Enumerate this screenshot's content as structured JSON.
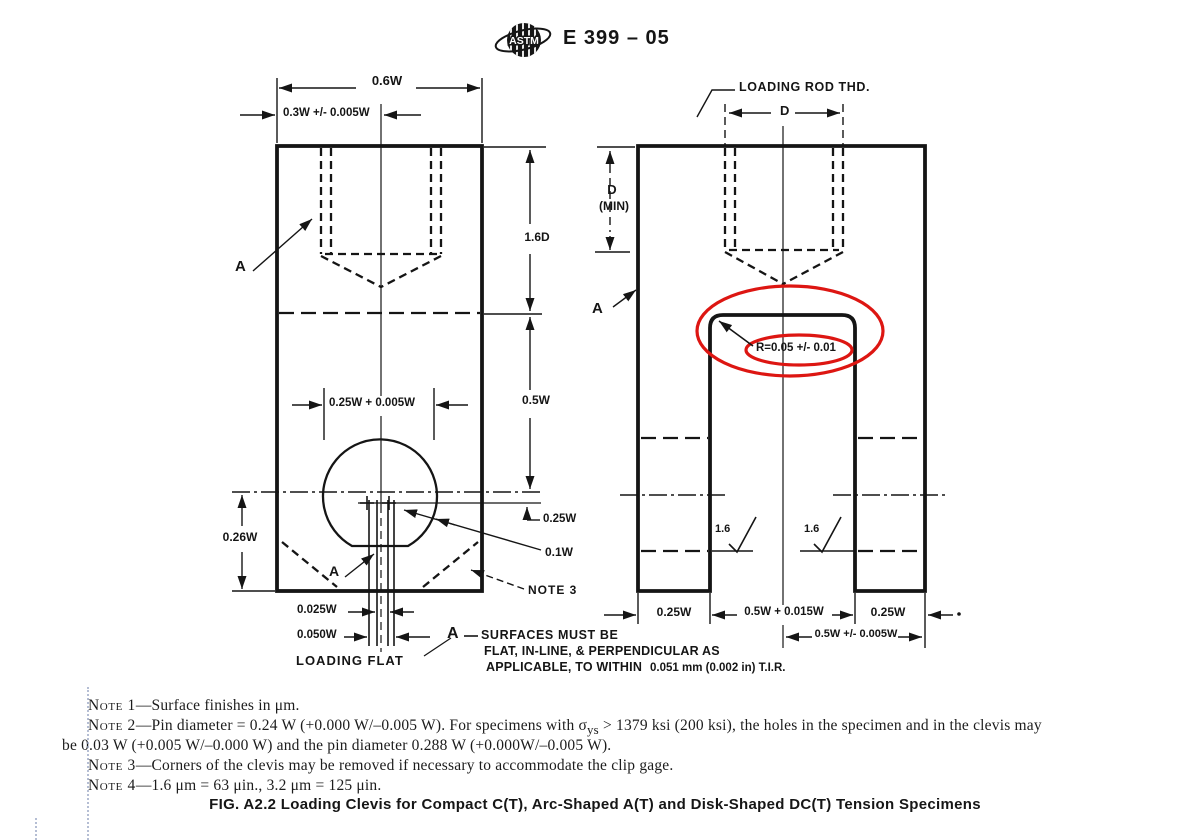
{
  "colors": {
    "ink": "#151515",
    "highlight_red": "#dd1612",
    "scan_artifact_blue": "#97a3c2"
  },
  "header": {
    "logo_text": "ASTM",
    "doc_code": "E 399 – 05"
  },
  "front_view": {
    "dim_width": "0.6W",
    "dim_half_width": "0.3W +/- 0.005W",
    "label_a_top": "A",
    "dim_thread_depth": "1.6D",
    "dim_body": "0.5W",
    "dim_hole": "0.25W + 0.005W",
    "dim_bottom": "0.26W",
    "dim_flat_offset": "0.25W",
    "dim_flat_height": "0.1W",
    "label_a_bottom": "A",
    "label_note3": "NOTE 3",
    "dim_flat_a": "0.025W",
    "dim_flat_b": "0.050W",
    "label_loading_flat": "LOADING FLAT"
  },
  "side_view": {
    "label_loading_rod": "LOADING ROD THD.",
    "dim_d": "D",
    "dim_d_min_line1": "D",
    "dim_d_min_line2": "(MIN)",
    "label_a": "A",
    "radius_callout": "R=0.05 +/- 0.01",
    "finish_left": "1.6",
    "finish_right": "1.6",
    "dim_leg_left": "0.25W",
    "dim_slot": "0.5W + 0.015W",
    "dim_leg_right": "0.25W",
    "dim_half": "0.5W +/- 0.005W"
  },
  "surface_callout": {
    "label": "A",
    "line1": "SURFACES MUST BE",
    "line2": "FLAT, IN-LINE, & PERPENDICULAR AS",
    "line3": "APPLICABLE, TO WITHIN",
    "tolerance": "0.051 mm (0.002 in) T.I.R."
  },
  "notes": {
    "n1": {
      "label": "Note 1",
      "body": "—Surface finishes in μm."
    },
    "n2": {
      "label": "Note 2",
      "body_pre": "—Pin diameter = 0.24 W (+0.000 W/–0.005 W). For specimens with σ",
      "sub": "ys",
      "body_post": " > 1379 ksi (200 ksi), the holes in the specimen and in the clevis may"
    },
    "n2_cont": "be 0.03 W (+0.005 W/–0.000 W) and the pin diameter 0.288 W (+0.000W/–0.005 W).",
    "n3": {
      "label": "Note 3",
      "body": "—Corners of the clevis may be removed if necessary to accommodate the clip gage."
    },
    "n4": {
      "label": "Note 4",
      "body": "—1.6 μm = 63 μin., 3.2 μm = 125 μin."
    }
  },
  "caption": "FIG. A2.2 Loading Clevis for Compact C(T), Arc-Shaped A(T) and Disk-Shaped DC(T) Tension Specimens"
}
